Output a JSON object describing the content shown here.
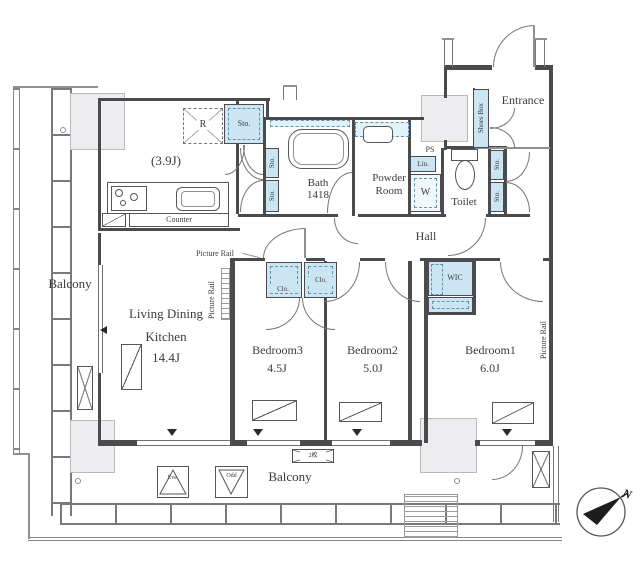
{
  "compass": {
    "north": "N"
  },
  "rooms": {
    "kitchen_size": "(3.9J)",
    "ldk1": "Living Dining",
    "ldk2": "Kitchen",
    "ldk_size": "14.4J",
    "bedroom1": "Bedroom1",
    "bedroom1_size": "6.0J",
    "bedroom2": "Bedroom2",
    "bedroom2_size": "5.0J",
    "bedroom3": "Bedroom3",
    "bedroom3_size": "4.5J",
    "bath1": "Bath",
    "bath2": "1418",
    "powder1": "Powder",
    "powder2": "Room",
    "toilet": "Toilet",
    "hall": "Hall",
    "entrance": "Entrance",
    "balcony_left": "Balcony",
    "balcony_bottom": "Balcony"
  },
  "labels": {
    "sto": "Sto.",
    "shoes_box": "Shoes Box",
    "wic": "WIC",
    "clo": "Clo.",
    "lin": "Lin.",
    "washer": "W",
    "ps": "PS",
    "fridge": "R",
    "counter": "Counter",
    "picture_rail": "Picture Rail",
    "hatch_even": "Eve.",
    "hatch_odd": "Odd",
    "panel_2": "2枚"
  },
  "colors": {
    "storage_fill": "#cbe5f3",
    "column_fill": "#ededef",
    "wall": "#4b4b4e"
  }
}
